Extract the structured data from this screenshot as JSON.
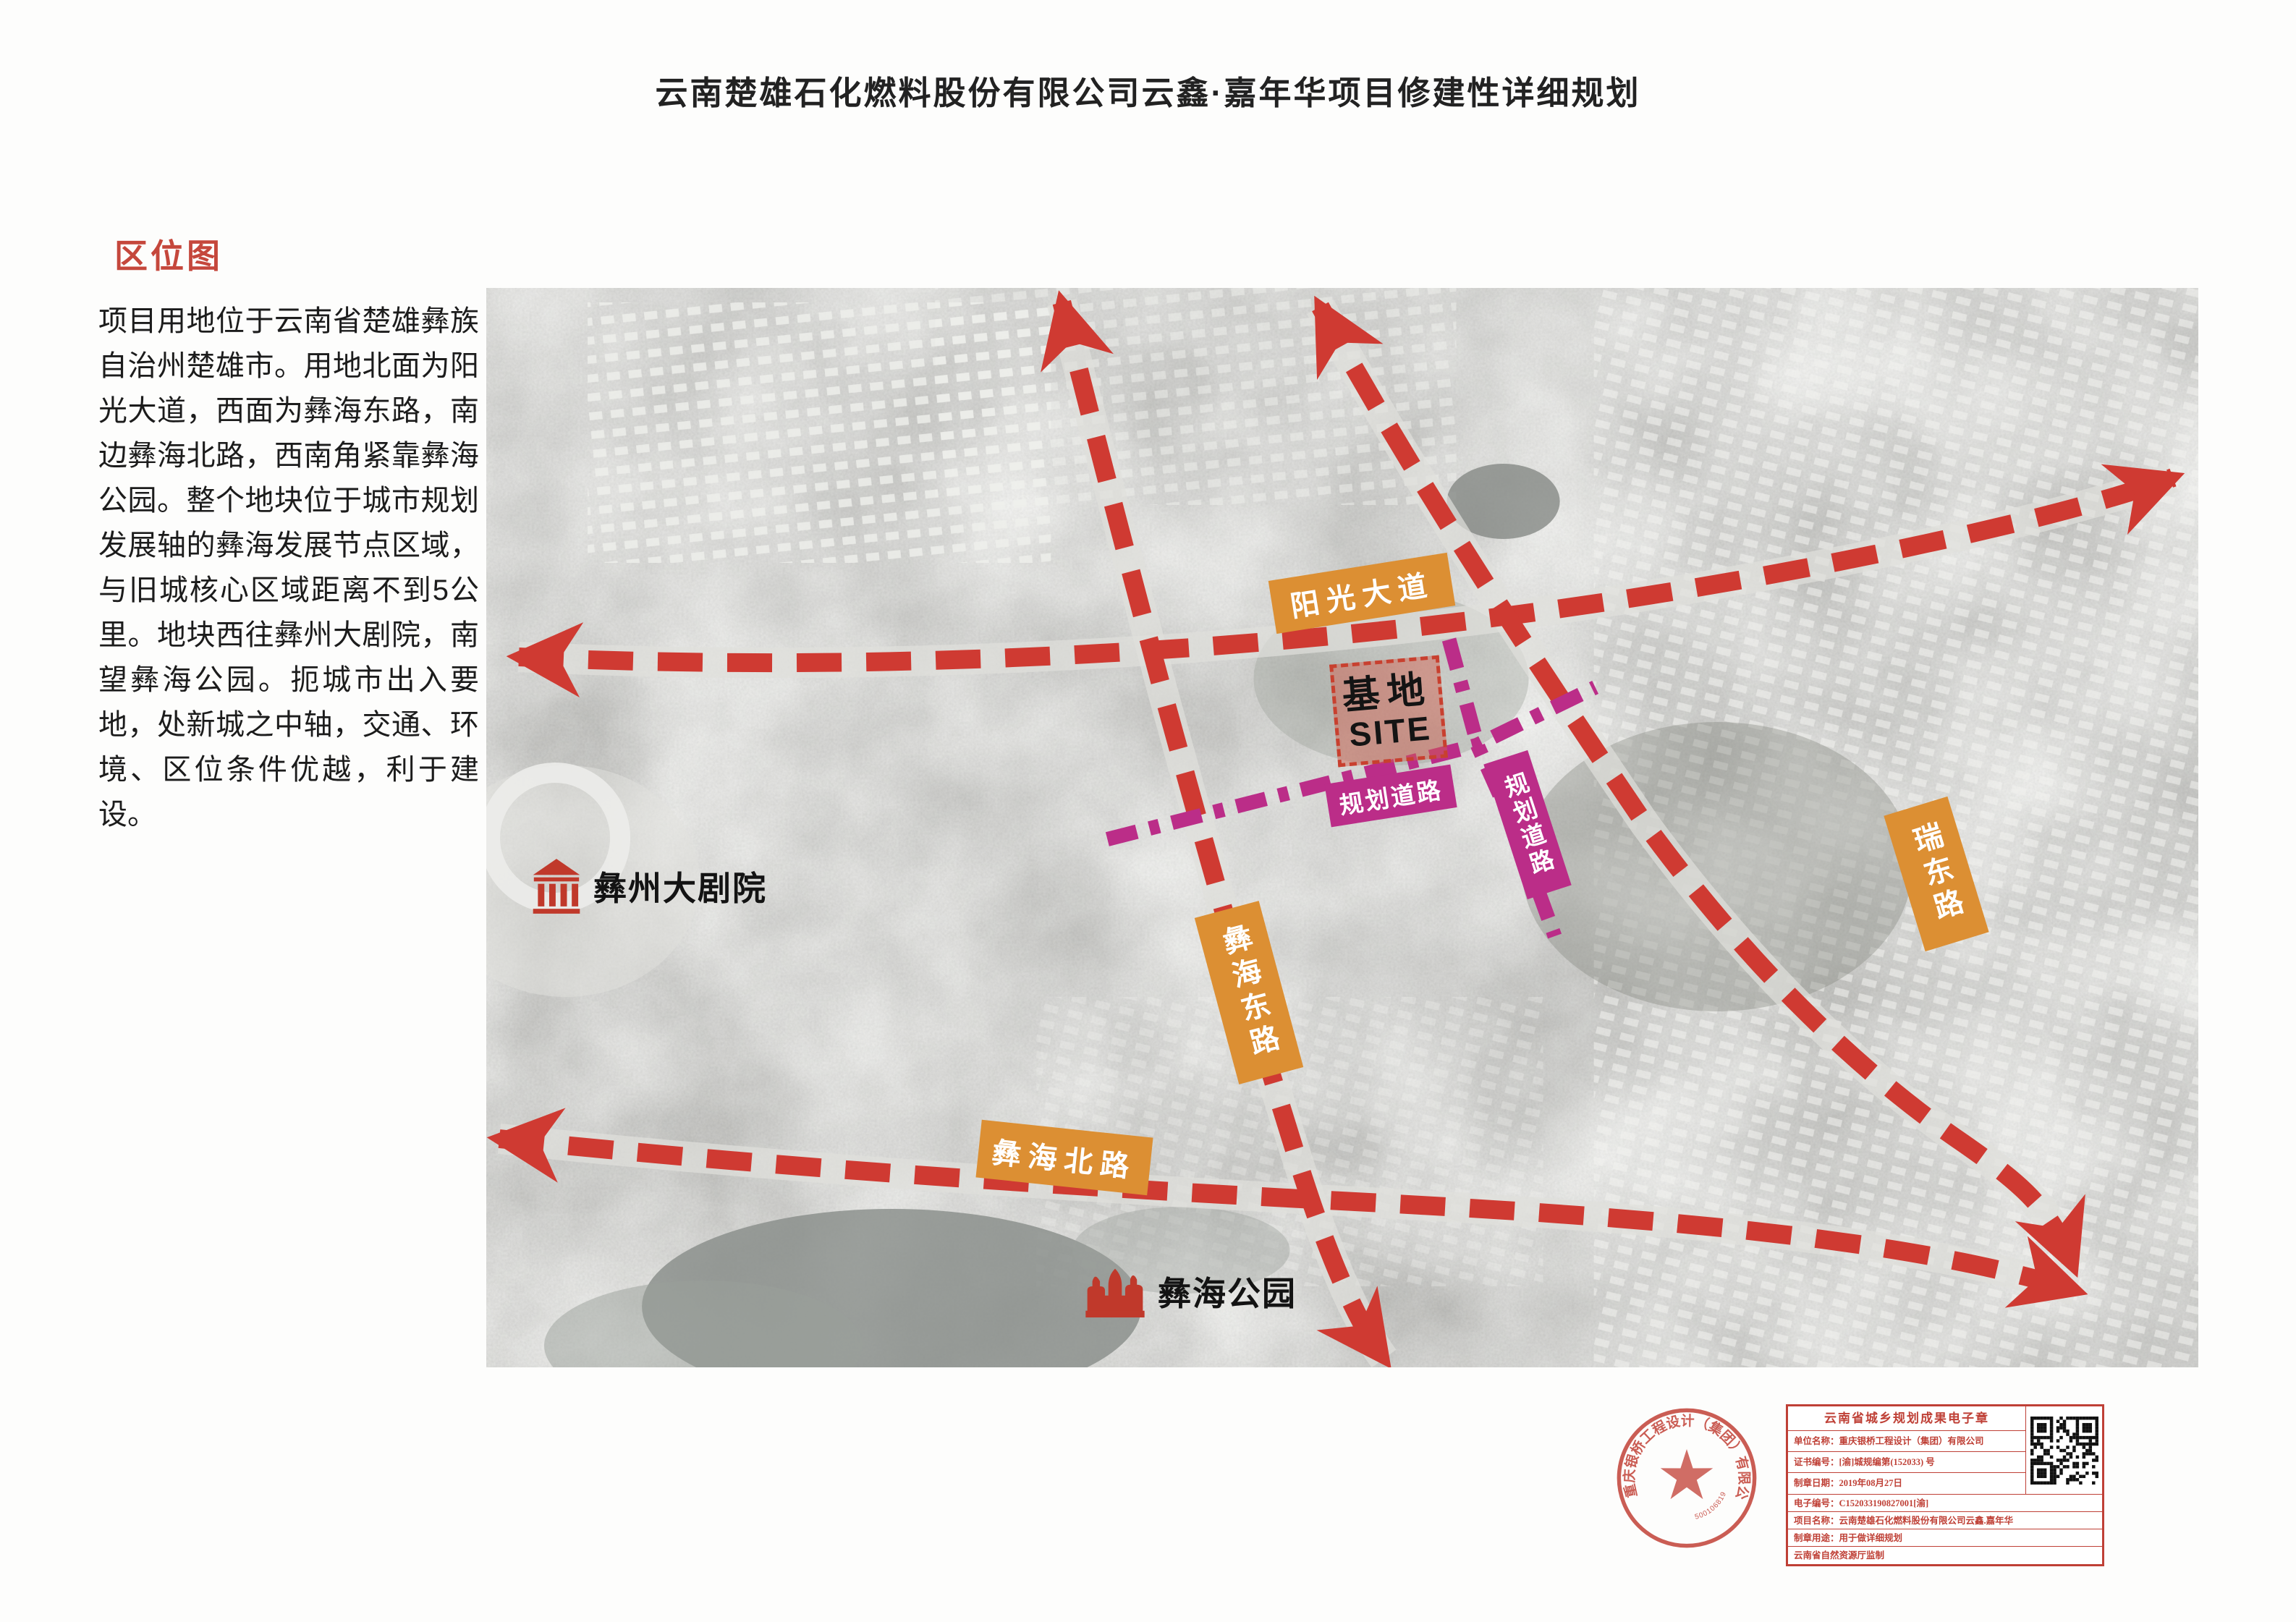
{
  "page": {
    "title": "云南楚雄石化燃料股份有限公司云鑫·嘉年华项目修建性详细规划"
  },
  "section": {
    "heading": "区位图",
    "paragraph": "项目用地位于云南省楚雄彝族自治州楚雄市。用地北面为阳光大道，西面为彝海东路，南边彝海北路，西南角紧靠彝海公园。整个地块位于城市规划发展轴的彝海发展节点区域，与旧城核心区域距离不到5公里。地块西往彝州大剧院，南望彝海公园。扼城市出入要地，处新城之中轴，交通、环境、区位条件优越，利于建设。"
  },
  "map": {
    "roads": {
      "sunshine_avenue": "阳光大道",
      "yihai_east_road": "彝海东路",
      "ruidong_road": "瑞东路",
      "yihai_north_road": "彝海北路",
      "planned_road_1": "规划道路",
      "planned_road_2": "规划道路"
    },
    "site": {
      "line1": "基地",
      "line2": "SITE"
    },
    "pois": {
      "theater": "彝州大剧院",
      "park": "彝海公园"
    }
  },
  "seal": {
    "company_ring": "重庆银桥工程设计（集团）有限公司",
    "number": "5001068195765"
  },
  "seal_table": {
    "title": "云南省城乡规划成果电子章",
    "rows": [
      {
        "label": "单位名称：",
        "value": "重庆银桥工程设计（集团）有限公司"
      },
      {
        "label": "证书编号：",
        "value": "[渝]城规编第(152033) 号"
      },
      {
        "label": "制章日期：",
        "value": "2019年08月27日"
      },
      {
        "label": "电子编号：",
        "value": "C152033190827001[渝]"
      },
      {
        "label": "项目名称：",
        "value": "云南楚雄石化燃料股份有限公司云鑫.嘉年华"
      },
      {
        "label": "制章用途：",
        "value": "用于做详细规划"
      },
      {
        "label": "",
        "value": "云南省自然资源厅监制"
      }
    ]
  },
  "colors": {
    "accent_red": "#c5473c",
    "road_red": "#cf3a32",
    "label_orange": "#dc8f33",
    "label_magenta": "#bb2d88",
    "site_border": "#c8402f",
    "seal_red": "#bf4036",
    "text_black": "#1c1c1c"
  }
}
